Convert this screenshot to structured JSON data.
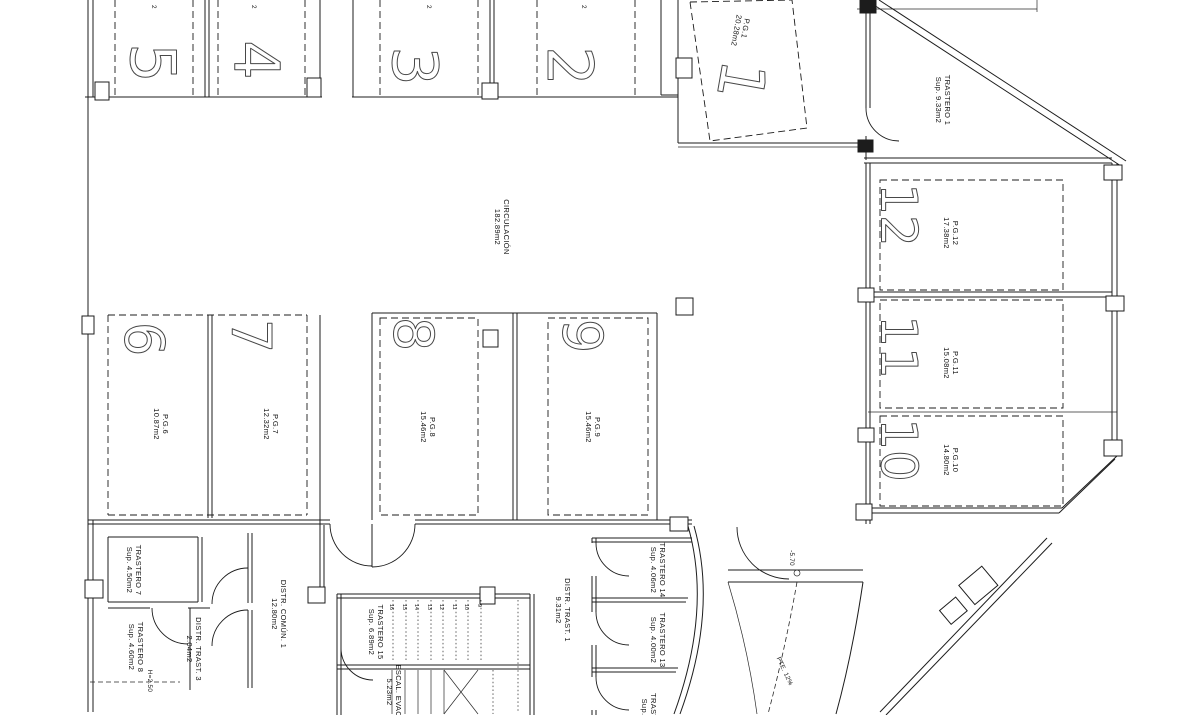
{
  "plan": {
    "circulation": {
      "name": "CIRCULACIÓN",
      "area": "182.89m2"
    },
    "annotations": {
      "level": "-5.70",
      "slope": "PTE. 12%",
      "height": "H=2.50",
      "edge_fragment": "2"
    },
    "parking": {
      "p1": {
        "num": "1",
        "code": "P.G.1",
        "area": "20.28m2"
      },
      "p2": {
        "num": "2"
      },
      "p3": {
        "num": "3"
      },
      "p4": {
        "num": "4"
      },
      "p5": {
        "num": "5"
      },
      "p6": {
        "num": "6",
        "code": "P.G.6",
        "area": "10.87m2"
      },
      "p7": {
        "num": "7",
        "code": "P.G.7",
        "area": "12.32m2"
      },
      "p8": {
        "num": "8",
        "code": "P.G.8",
        "area": "15.46m2"
      },
      "p9": {
        "num": "9",
        "code": "P.G.9",
        "area": "15.46m2"
      },
      "p10": {
        "num": "10",
        "code": "P.G.10",
        "area": "14.80m2"
      },
      "p11": {
        "num": "11",
        "code": "P.G.11",
        "area": "15.08m2"
      },
      "p12": {
        "num": "12",
        "code": "P.G.12",
        "area": "17.38m2"
      }
    },
    "rooms": {
      "trastero1": {
        "name": "TRASTERO 1",
        "area": "Sup. 9.33m2"
      },
      "trastero7": {
        "name": "TRASTERO 7",
        "area": "Sup. 4.50m2"
      },
      "trastero8": {
        "name": "TRASTERO 8",
        "area": "Sup. 4.60m2"
      },
      "trastero13": {
        "name": "TRASTERO 13",
        "area": "Sup. 4.00m2"
      },
      "trastero14": {
        "name": "TRASTERO 14",
        "area": "Sup. 4.06m2"
      },
      "trastero15": {
        "name": "TRASTERO 15",
        "area": "Sup. 6.89m2"
      },
      "trastero12_partial": {
        "name": "TRAST.",
        "area": "Sup."
      },
      "distr_comun1": {
        "name": "DISTR. COMÚN. 1",
        "area": "12.80m2"
      },
      "distr_trast1": {
        "name": "DISTR. TRAST. 1",
        "area": "9.31m2"
      },
      "distr_trast3": {
        "name": "DISTR. TRAST. 3",
        "area": "2.04m2"
      },
      "escalera": {
        "name": "ESCAL. EVAC.",
        "area": "5.23m2"
      }
    },
    "stair_treads": [
      "16",
      "15",
      "14",
      "13",
      "12",
      "11",
      "10",
      "9"
    ]
  }
}
